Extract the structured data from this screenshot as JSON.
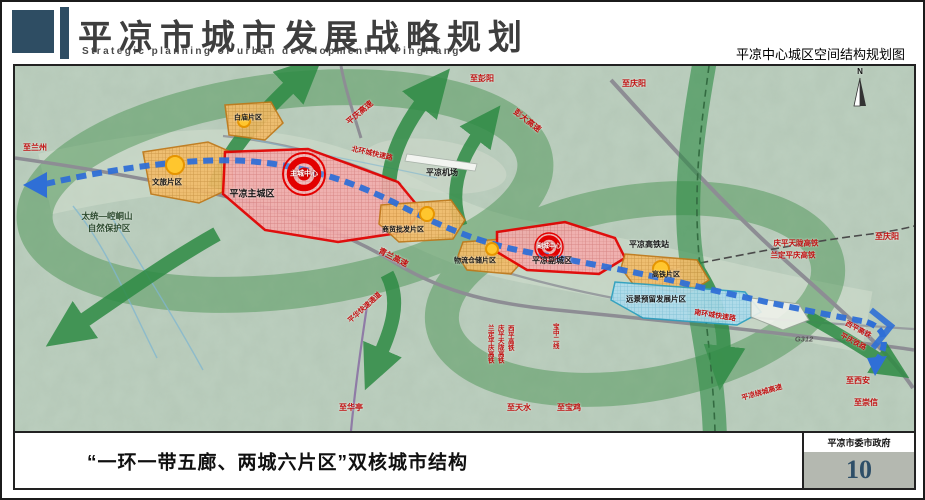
{
  "header": {
    "title": "平凉市城市发展战略规划",
    "subtitle_en": "Strategic planning of urban development in Pingliang",
    "map_caption": "平凉中心城区空间结构规划图",
    "accent_color": "#2e4d63"
  },
  "footer": {
    "caption": "“一环一带五廊、两城六片区”双核城市结构",
    "organization": "平凉市委市政府",
    "page_number": "10"
  },
  "map": {
    "compass": "N",
    "labels": {
      "to_lanzhou": "至兰州",
      "baimiao_zone": "白庙片区",
      "pingqing_expwy": "平庆高速",
      "to_pengyang": "至彭阳",
      "pengda_expwy": "彭大高速",
      "to_qingyang_top": "至庆阳",
      "north_ring_expwy": "北环城快速路",
      "wenlv_zone": "文旅片区",
      "main_city": "平凉主城区",
      "main_core": "主城中心",
      "nature_reserve_line1": "太统—崆峒山",
      "nature_reserve_line2": "自然保护区",
      "airport": "平凉机场",
      "shangmao_zone": "商贸批发片区",
      "qinglan_expwy": "青兰高速",
      "wuliu_zone": "物流仓储片区",
      "sub_core": "副城中心",
      "sub_city": "平凉副城区",
      "hsr_station": "平凉高铁站",
      "gaotie_zone": "高铁片区",
      "yuanjing_zone": "远景预留发展片区",
      "south_ring_expwy": "南环城快速路",
      "pinghua_corridor": "平华快速通道",
      "qptl_hsr": "庆平天陇高铁",
      "ldpq_hsr": "兰定平庆高铁",
      "to_qingyang_right": "至庆阳",
      "g312": "G312",
      "xiping_hsr_diag": "西平高铁",
      "pingqing_rail_diag": "平庆铁路",
      "raocheng_expwy": "平凉绕城高速",
      "to_xian": "至西安",
      "to_chongxin": "至崇信",
      "to_huating": "至华亭",
      "to_tianshui": "至天水",
      "to_baoji": "至宝鸡",
      "v_ldpq_hsr": "兰定平庆高铁",
      "v_qptl_hsr": "庆平天陇高铁",
      "v_xiping_hsr": "西平高铁",
      "v_baozhong": "宝中二线"
    },
    "colors": {
      "terrain": "#bccfbf",
      "corridor_green": "#2e8b44",
      "axis_blue": "#2f6fd6",
      "zone_orange": "#f2bc6a",
      "city_red": "#e30000",
      "reserve_blue": "#aedced",
      "road_label_red": "#c01010"
    }
  }
}
